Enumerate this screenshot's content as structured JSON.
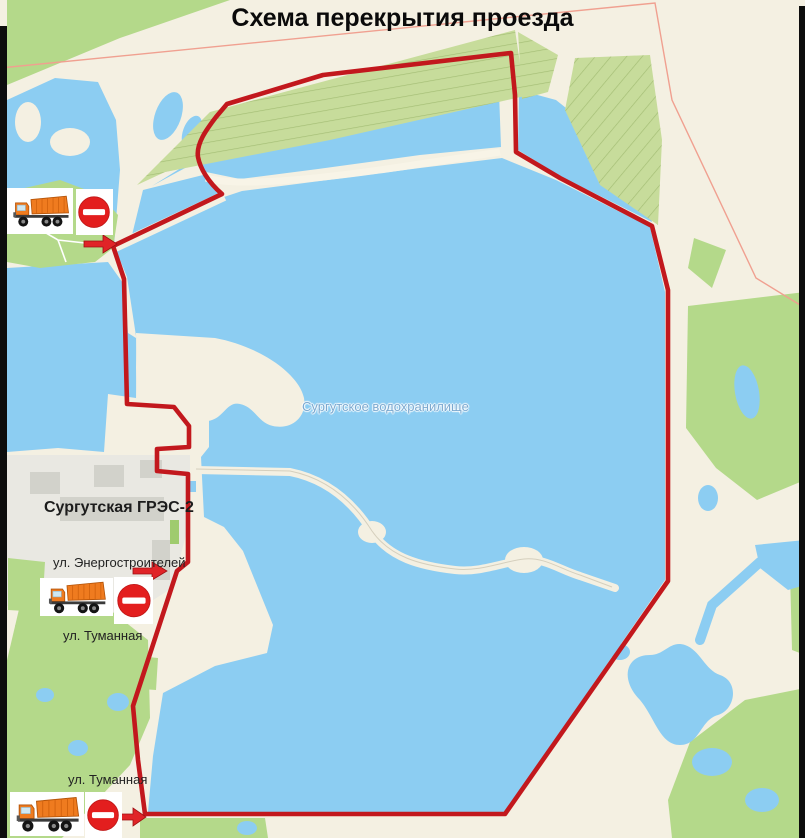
{
  "title": "Схема перекрытия проезда",
  "map": {
    "water_label": "Сургутское водохранилище",
    "plant_label": "Сургутская ГРЭС-2",
    "street_energostroiteley": "ул. Энергостроителей",
    "street_tumannaya_mid": "ул. Туманная",
    "street_tumannaya_bottom": "ул. Туманная",
    "colors": {
      "route_red": "#c2181d",
      "water_blue": "#8ccdf2",
      "land_cream": "#f4f0e2",
      "vegetation_green": "#b4d98a",
      "no_entry_red": "#e31e1e",
      "truck_orange": "#ef7b1f"
    }
  }
}
